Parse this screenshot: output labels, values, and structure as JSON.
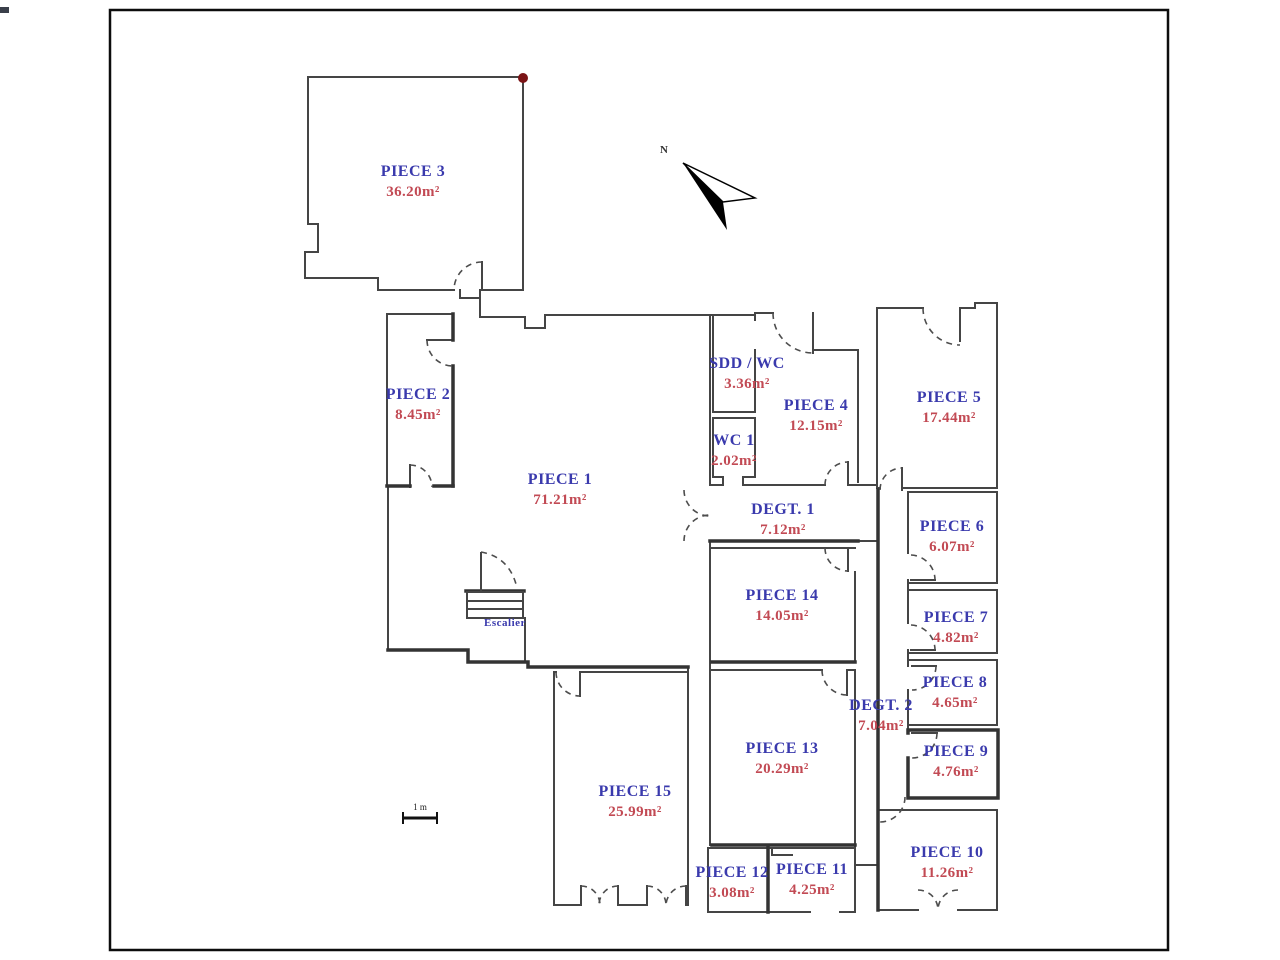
{
  "page": {
    "background": "#ffffff",
    "frame_color": "#0d0d0d"
  },
  "colors": {
    "room_name": "#3a3aad",
    "room_area": "#c24a54",
    "wall": "#454545",
    "thick_wall": "#333333",
    "door_arc": "#4d4d4d",
    "marker_dot": "#7b1416",
    "north_arrow": "#000000"
  },
  "annotations": {
    "north_label": "N",
    "scale_label": "1 m",
    "stairs_label": "Escalier"
  },
  "rooms": [
    {
      "name": "PIECE 1",
      "area": "71.21m²",
      "x": 560,
      "y": 484
    },
    {
      "name": "PIECE 2",
      "area": "8.45m²",
      "x": 418,
      "y": 399
    },
    {
      "name": "PIECE 3",
      "area": "36.20m²",
      "x": 413,
      "y": 176
    },
    {
      "name": "PIECE 4",
      "area": "12.15m²",
      "x": 816,
      "y": 410
    },
    {
      "name": "PIECE 5",
      "area": "17.44m²",
      "x": 949,
      "y": 402
    },
    {
      "name": "PIECE 6",
      "area": "6.07m²",
      "x": 952,
      "y": 531
    },
    {
      "name": "PIECE 7",
      "area": "4.82m²",
      "x": 956,
      "y": 622
    },
    {
      "name": "PIECE 8",
      "area": "4.65m²",
      "x": 955,
      "y": 687
    },
    {
      "name": "PIECE 9",
      "area": "4.76m²",
      "x": 956,
      "y": 756
    },
    {
      "name": "PIECE 10",
      "area": "11.26m²",
      "x": 947,
      "y": 857
    },
    {
      "name": "PIECE 11",
      "area": "4.25m²",
      "x": 812,
      "y": 874
    },
    {
      "name": "PIECE 12",
      "area": "3.08m²",
      "x": 732,
      "y": 877
    },
    {
      "name": "PIECE 13",
      "area": "20.29m²",
      "x": 782,
      "y": 753
    },
    {
      "name": "PIECE 14",
      "area": "14.05m²",
      "x": 782,
      "y": 600
    },
    {
      "name": "PIECE 15",
      "area": "25.99m²",
      "x": 635,
      "y": 796
    },
    {
      "name": "SDD / WC",
      "area": "3.36m²",
      "x": 747,
      "y": 368
    },
    {
      "name": "WC 1",
      "area": "2.02m²",
      "x": 734,
      "y": 445
    },
    {
      "name": "DEGT. 1",
      "area": "7.12m²",
      "x": 783,
      "y": 514
    },
    {
      "name": "DEGT. 2",
      "area": "7.04m²",
      "x": 881,
      "y": 710
    }
  ]
}
